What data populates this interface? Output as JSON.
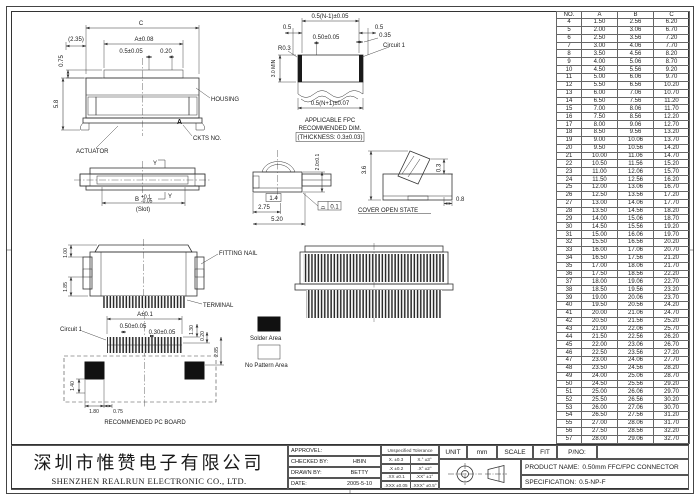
{
  "company": {
    "cn": "深圳市惟赞电子有限公司",
    "en": "SHENZHEN REALRUN ELECTRONIC CO., LTD."
  },
  "title_block": {
    "signoff_rows": [
      [
        "APPROVEL:",
        ""
      ],
      [
        "CHECKED BY:",
        "HBIN"
      ],
      [
        "DRAWN BY:",
        "BETTY"
      ],
      [
        "DATE:",
        "2005-5-10"
      ]
    ],
    "tolerance": {
      "header": "Unspecified Tolerance",
      "rows": [
        [
          "X. ±0.3",
          "X.° ±3°"
        ],
        [
          ".X ±0.2",
          ".X° ±2°"
        ],
        [
          ".XX ±0.1",
          ".XX° ±1°"
        ],
        [
          ".XXX ±0.05",
          ".XXX° ±0.5°"
        ]
      ]
    },
    "unit_label": "UNIT",
    "unit_value": "mm",
    "scale_label": "SCALE",
    "fit_label": "FIT",
    "pno_label": "P/NO:",
    "product_name_label": "PRODUCT NAME:",
    "product_name_value": "0.50mm FFC/FPC CONNECTOR",
    "spec_label": "SPECIFICATION:",
    "spec_value": "0.5-NP-F"
  },
  "dim_table": {
    "headers": [
      "NO.",
      "A",
      "B",
      "C"
    ],
    "rows": [
      [
        "4",
        "1.50",
        "2.56",
        "6.20"
      ],
      [
        "5",
        "2.00",
        "3.06",
        "6.70"
      ],
      [
        "6",
        "2.50",
        "3.56",
        "7.20"
      ],
      [
        "7",
        "3.00",
        "4.06",
        "7.70"
      ],
      [
        "8",
        "3.50",
        "4.56",
        "8.20"
      ],
      [
        "9",
        "4.00",
        "5.06",
        "8.70"
      ],
      [
        "10",
        "4.50",
        "5.56",
        "9.20"
      ],
      [
        "11",
        "5.00",
        "6.06",
        "9.70"
      ],
      [
        "12",
        "5.50",
        "6.56",
        "10.20"
      ],
      [
        "13",
        "6.00",
        "7.06",
        "10.70"
      ],
      [
        "14",
        "6.50",
        "7.56",
        "11.20"
      ],
      [
        "15",
        "7.00",
        "8.06",
        "11.70"
      ],
      [
        "16",
        "7.50",
        "8.56",
        "12.20"
      ],
      [
        "17",
        "8.00",
        "9.06",
        "12.70"
      ],
      [
        "18",
        "8.50",
        "9.56",
        "13.20"
      ],
      [
        "19",
        "9.00",
        "10.06",
        "13.70"
      ],
      [
        "20",
        "9.50",
        "10.56",
        "14.20"
      ],
      [
        "21",
        "10.00",
        "11.06",
        "14.70"
      ],
      [
        "22",
        "10.50",
        "11.56",
        "15.20"
      ],
      [
        "23",
        "11.00",
        "12.06",
        "15.70"
      ],
      [
        "24",
        "11.50",
        "12.56",
        "16.20"
      ],
      [
        "25",
        "12.00",
        "13.06",
        "16.70"
      ],
      [
        "26",
        "12.50",
        "13.56",
        "17.20"
      ],
      [
        "27",
        "13.00",
        "14.06",
        "17.70"
      ],
      [
        "28",
        "13.50",
        "14.56",
        "18.20"
      ],
      [
        "29",
        "14.00",
        "15.06",
        "18.70"
      ],
      [
        "30",
        "14.50",
        "15.56",
        "19.20"
      ],
      [
        "31",
        "15.00",
        "16.06",
        "19.70"
      ],
      [
        "32",
        "15.50",
        "16.56",
        "20.20"
      ],
      [
        "33",
        "16.00",
        "17.06",
        "20.70"
      ],
      [
        "34",
        "16.50",
        "17.56",
        "21.20"
      ],
      [
        "35",
        "17.00",
        "18.06",
        "21.70"
      ],
      [
        "36",
        "17.50",
        "18.56",
        "22.20"
      ],
      [
        "37",
        "18.00",
        "19.06",
        "22.70"
      ],
      [
        "38",
        "18.50",
        "19.56",
        "23.20"
      ],
      [
        "39",
        "19.00",
        "20.06",
        "23.70"
      ],
      [
        "40",
        "19.50",
        "20.56",
        "24.20"
      ],
      [
        "41",
        "20.00",
        "21.06",
        "24.70"
      ],
      [
        "42",
        "20.50",
        "21.56",
        "25.20"
      ],
      [
        "43",
        "21.00",
        "22.06",
        "25.70"
      ],
      [
        "44",
        "21.50",
        "22.56",
        "26.20"
      ],
      [
        "45",
        "22.00",
        "23.06",
        "26.70"
      ],
      [
        "46",
        "22.50",
        "23.56",
        "27.20"
      ],
      [
        "47",
        "23.00",
        "24.06",
        "27.70"
      ],
      [
        "48",
        "23.50",
        "24.56",
        "28.20"
      ],
      [
        "49",
        "24.00",
        "25.06",
        "28.70"
      ],
      [
        "50",
        "24.50",
        "25.56",
        "29.20"
      ],
      [
        "51",
        "25.00",
        "26.06",
        "29.70"
      ],
      [
        "52",
        "25.50",
        "26.56",
        "30.20"
      ],
      [
        "53",
        "26.00",
        "27.06",
        "30.70"
      ],
      [
        "54",
        "26.50",
        "27.56",
        "31.20"
      ],
      [
        "55",
        "27.00",
        "28.06",
        "31.70"
      ],
      [
        "56",
        "27.50",
        "28.56",
        "32.20"
      ],
      [
        "57",
        "28.00",
        "29.06",
        "32.70"
      ]
    ]
  },
  "views": {
    "front": {
      "dim_c": "C",
      "dim_235": "(2.35)",
      "dim_a": "A±0.08",
      "dim_pitch": "0.5±0.05",
      "dim_020": "0.20",
      "dim_075": "0.75",
      "dim_58": "5.8",
      "label_housing": "HOUSING",
      "label_actuator": "ACTUATOR",
      "label_ckts": "CKTS NO.",
      "mark_a": "A"
    },
    "fpc": {
      "dim_top": "0.5(N-1)±0.05",
      "dim_05l": "0.5",
      "dim_05r": "0.5",
      "dim_pitch": "0.50±0.05",
      "dim_035": "0.35",
      "label_circuit": "Circuit 1",
      "dim_r03": "R0.3",
      "dim_30min": "3.0 MIN",
      "dim_bottom": "0.5(N+1)±0.07",
      "caption1": "APPLICABLE FPC",
      "caption2": "RECOMMENDED DIM.",
      "caption3": "(THICKNESS: 0.3±0.03)"
    },
    "slot": {
      "mark_y_top": "Y",
      "mark_y_bot": "Y",
      "dim_b": "B",
      "dim_b_tol_up": "+0.1",
      "dim_b_tol_dn": "-0.05",
      "label_slot": "(Slot)"
    },
    "dome": {
      "dim_20": "2.0±0.1",
      "dim_14": "1.4",
      "dim_275": "2.75",
      "dim_520": "5.20",
      "flatness_symbol": "⌓",
      "flatness_value": "0.1"
    },
    "cover": {
      "dim_36": "3.6",
      "dim_03": "0.3",
      "dim_08": "0.8",
      "label": "COVER OPEN STATE"
    },
    "fitting": {
      "dim_100": "1.00",
      "dim_185": "1.85",
      "label_nail": "FITTING NAIL",
      "label_terminal": "TERMINAL"
    },
    "pcb": {
      "label_circuit": "Circuit 1",
      "dim_a": "A±0.1",
      "dim_050": "0.50±0.05",
      "dim_030": "0.30±0.05",
      "dim_130": "1.30",
      "dim_020": "0.20",
      "dim_285": "2.85",
      "dim_140": "1.40",
      "dim_180": "1.80",
      "dim_075": "0.75",
      "caption": "RECOMMENDED PC BOARD"
    }
  },
  "legend": {
    "solder": "Solder Area",
    "no_pattern": "No Pattern Area"
  },
  "colors": {
    "line": "#333333",
    "solid_fill": "#111111"
  }
}
